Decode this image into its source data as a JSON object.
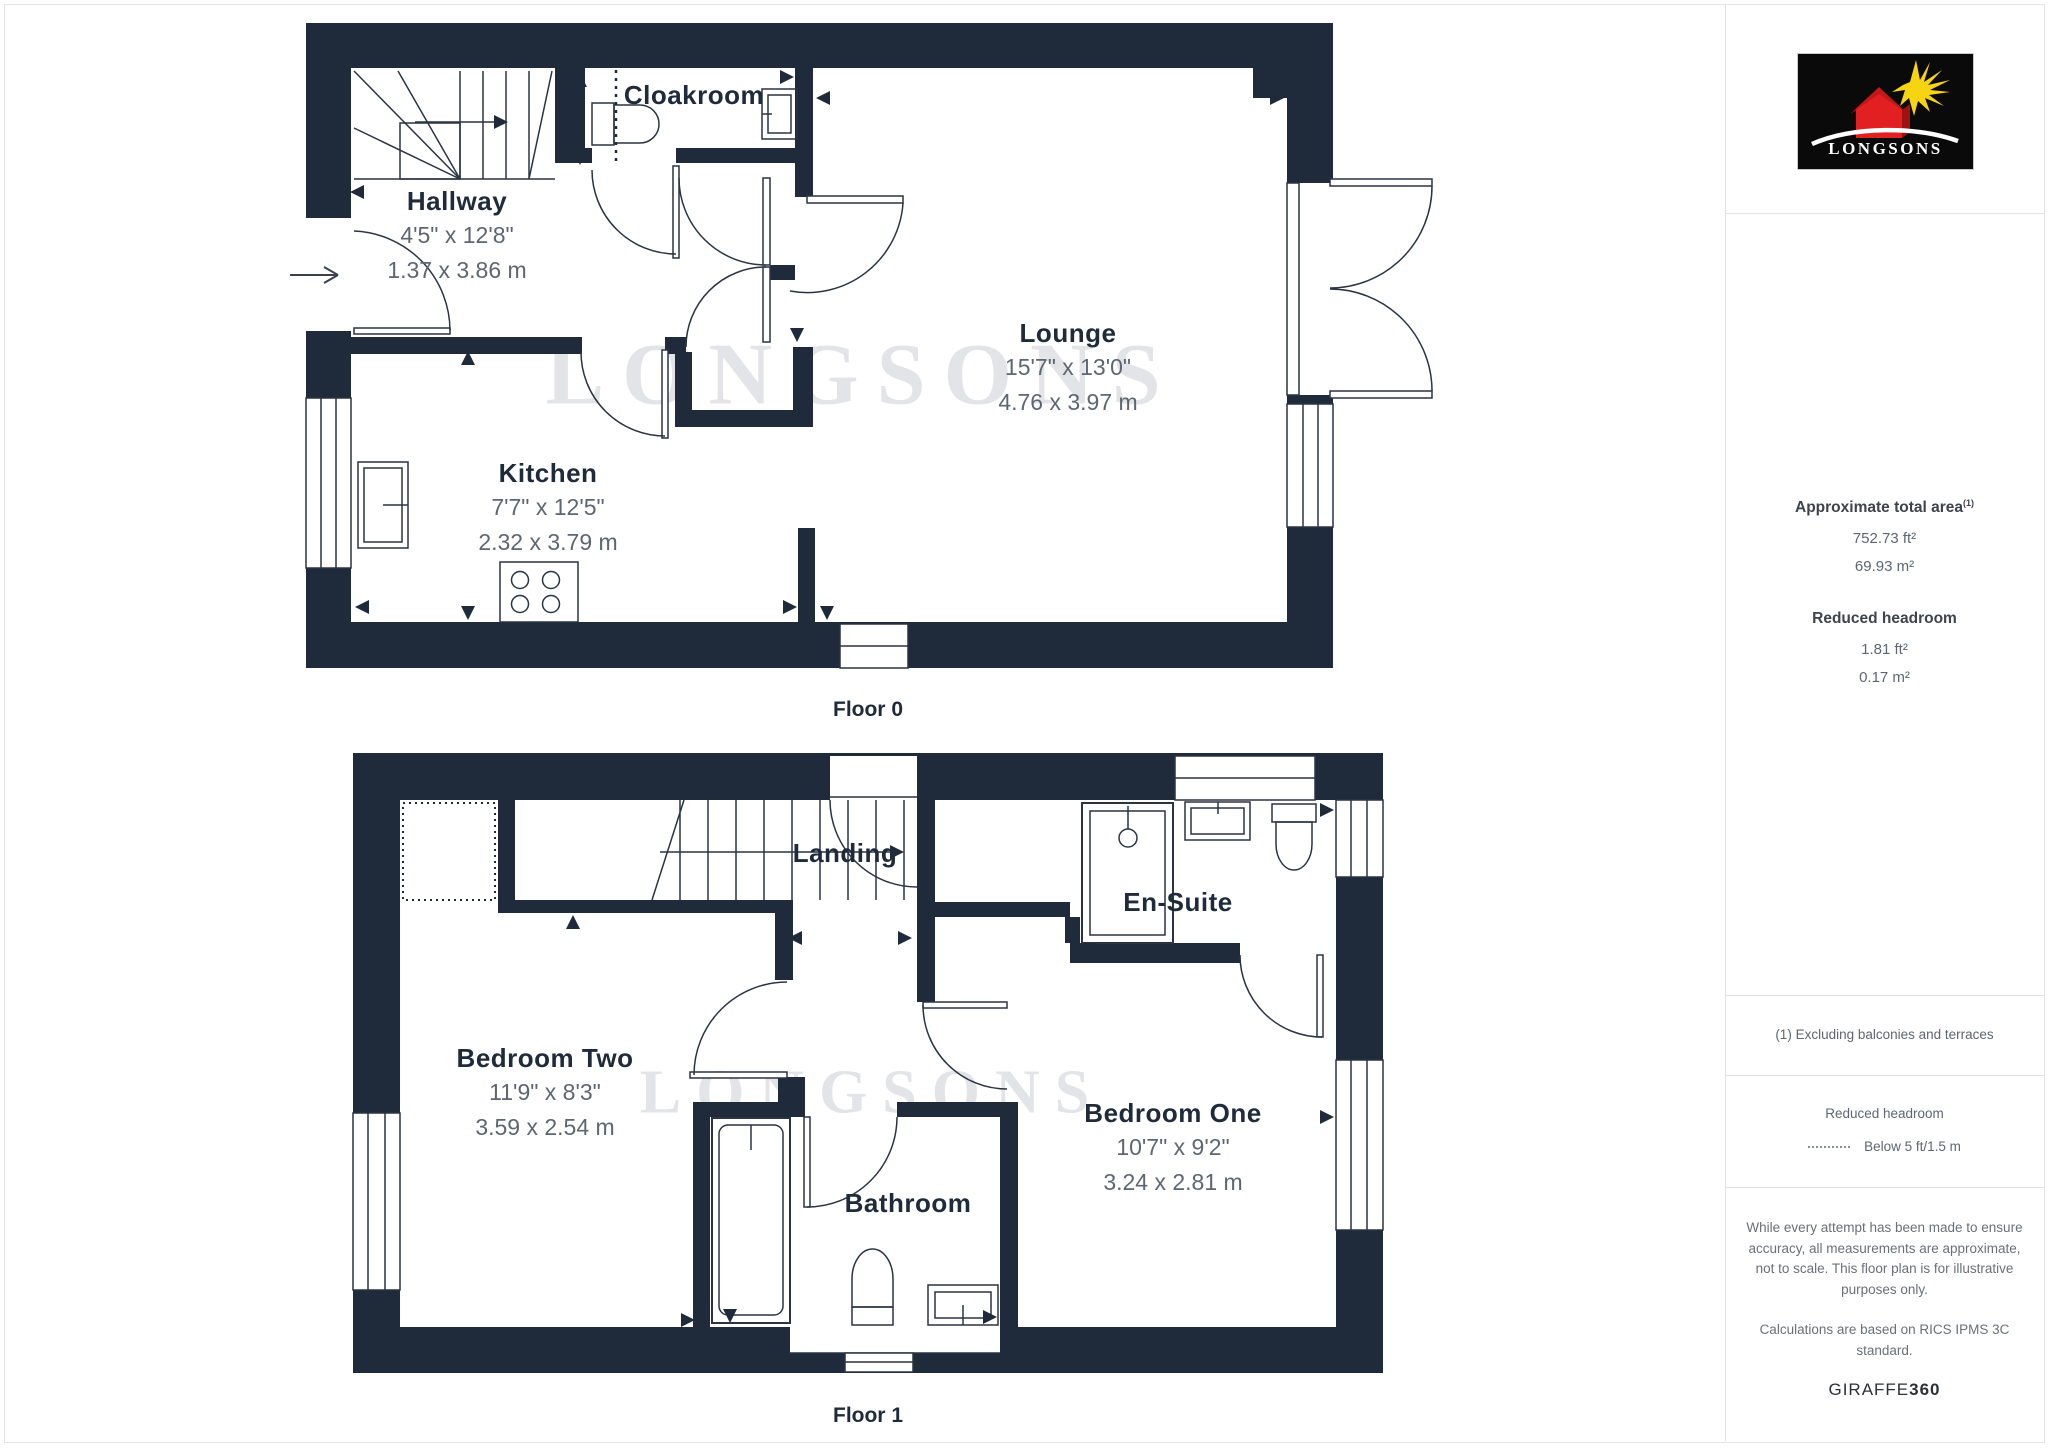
{
  "page": {
    "wall_color": "#1f2b3a",
    "line_color": "#2a3442",
    "dim_text_color": "#5d6671",
    "border_color": "#e4e4e6",
    "watermark_color": "#e3e4e7"
  },
  "branding": {
    "logo_text": "LONGSONS",
    "watermark": "LONGSONS",
    "logo_bg": "#0a0a0b",
    "logo_red": "#e32021",
    "logo_sun": "#f7d411"
  },
  "floor0": {
    "caption": "Floor 0",
    "rooms": {
      "hallway": {
        "name": "Hallway",
        "dims_ft": "4'5\" x 12'8\"",
        "dims_m": "1.37 x 3.86 m"
      },
      "cloakroom": {
        "name": "Cloakroom"
      },
      "kitchen": {
        "name": "Kitchen",
        "dims_ft": "7'7\" x 12'5\"",
        "dims_m": "2.32 x 3.79 m"
      },
      "lounge": {
        "name": "Lounge",
        "dims_ft": "15'7\" x 13'0\"",
        "dims_m": "4.76 x 3.97 m"
      }
    }
  },
  "floor1": {
    "caption": "Floor 1",
    "rooms": {
      "landing": {
        "name": "Landing"
      },
      "bedroom_two": {
        "name": "Bedroom Two",
        "dims_ft": "11'9\" x 8'3\"",
        "dims_m": "3.59 x 2.54 m"
      },
      "en_suite": {
        "name": "En-Suite"
      },
      "bedroom_one": {
        "name": "Bedroom One",
        "dims_ft": "10'7\" x 9'2\"",
        "dims_m": "3.24 x 2.81 m"
      },
      "bathroom": {
        "name": "Bathroom"
      }
    }
  },
  "sidebar": {
    "area": {
      "heading": "Approximate total area",
      "heading_sup": "(1)",
      "value_ft": "752.73 ft²",
      "value_m": "69.93 m²"
    },
    "reduced": {
      "heading": "Reduced headroom",
      "value_ft": "1.81 ft²",
      "value_m": "0.17 m²"
    },
    "footnote": "(1) Excluding balconies and terraces",
    "legend": {
      "title": "Reduced headroom",
      "entry": "Below 5 ft/1.5 m"
    },
    "disclaimer_1": "While every attempt has been made to ensure accuracy, all measurements are approximate, not to scale. This floor plan is for illustrative purposes only.",
    "disclaimer_2": "Calculations are based on RICS IPMS 3C standard.",
    "credit_normal": "GIRAFFE",
    "credit_bold": "360"
  }
}
